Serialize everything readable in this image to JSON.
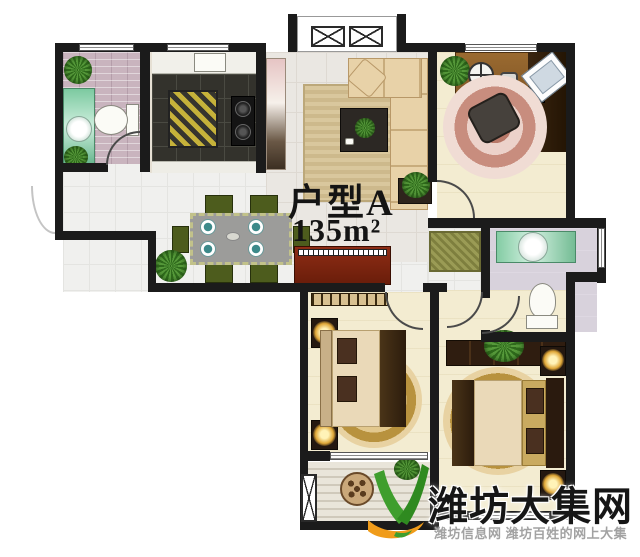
{
  "plan": {
    "type_label": "户型A",
    "area_label": "135m²"
  },
  "watermark": {
    "site_name": "潍坊大集网",
    "tagline": "潍坊信息网 潍坊百姓的网上大集",
    "logo_icon": "leaf-v-swoosh-logo"
  },
  "colors": {
    "wall": "#1b1b1b",
    "label_text": "#141414",
    "piano_red": "#8e2d15",
    "hall_mat": "#9a9b55",
    "kitchen_mat": "#c6b23a",
    "chair_green": "#4d5c1d",
    "rug_gold": "#c9a95c",
    "rug_pink": "#c88d7e",
    "logo_green": "#3f9e2d",
    "logo_green_dark": "#2f8a20",
    "logo_orange": "#f09c1a",
    "watermark_title": "#161616",
    "watermark_tagline": "#a2a2a2"
  }
}
